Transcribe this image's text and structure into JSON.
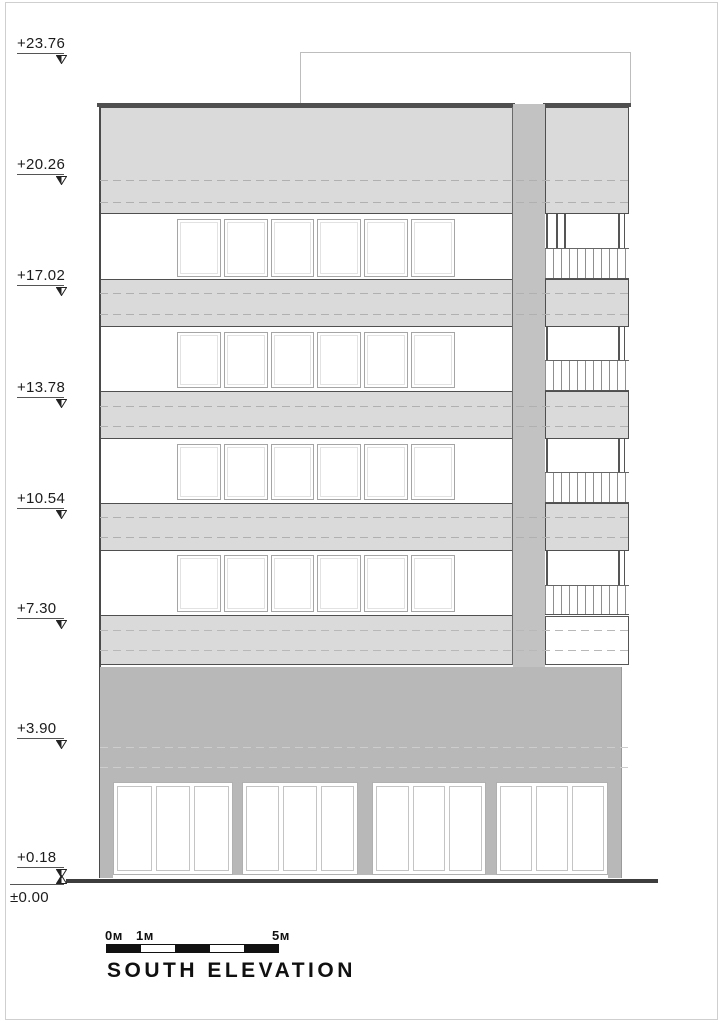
{
  "title": "SOUTH ELEVATION",
  "levels": [
    "+23.76",
    "+20.26",
    "+17.02",
    "+13.78",
    "+10.54",
    "+7.30",
    "+3.90",
    "+0.18",
    "±0.00"
  ],
  "scale_bar": {
    "labels": [
      "0м",
      "1м",
      "5м"
    ],
    "segments": 5
  },
  "facade": {
    "window_rows": 4,
    "panes_per_row": 6,
    "balcony_floors": 4,
    "storefront_groups": 4,
    "storefront_panes_per_group": 3
  },
  "colors": {
    "band_light": "#dadada",
    "core_gray": "#c2c2c2",
    "podium_gray": "#b8b8b8",
    "line_dark": "#4f4f4f",
    "ground": "#3d3d3d",
    "dash_light_band": "#b0b0b0",
    "dash_podium": "#cdcdcd"
  }
}
